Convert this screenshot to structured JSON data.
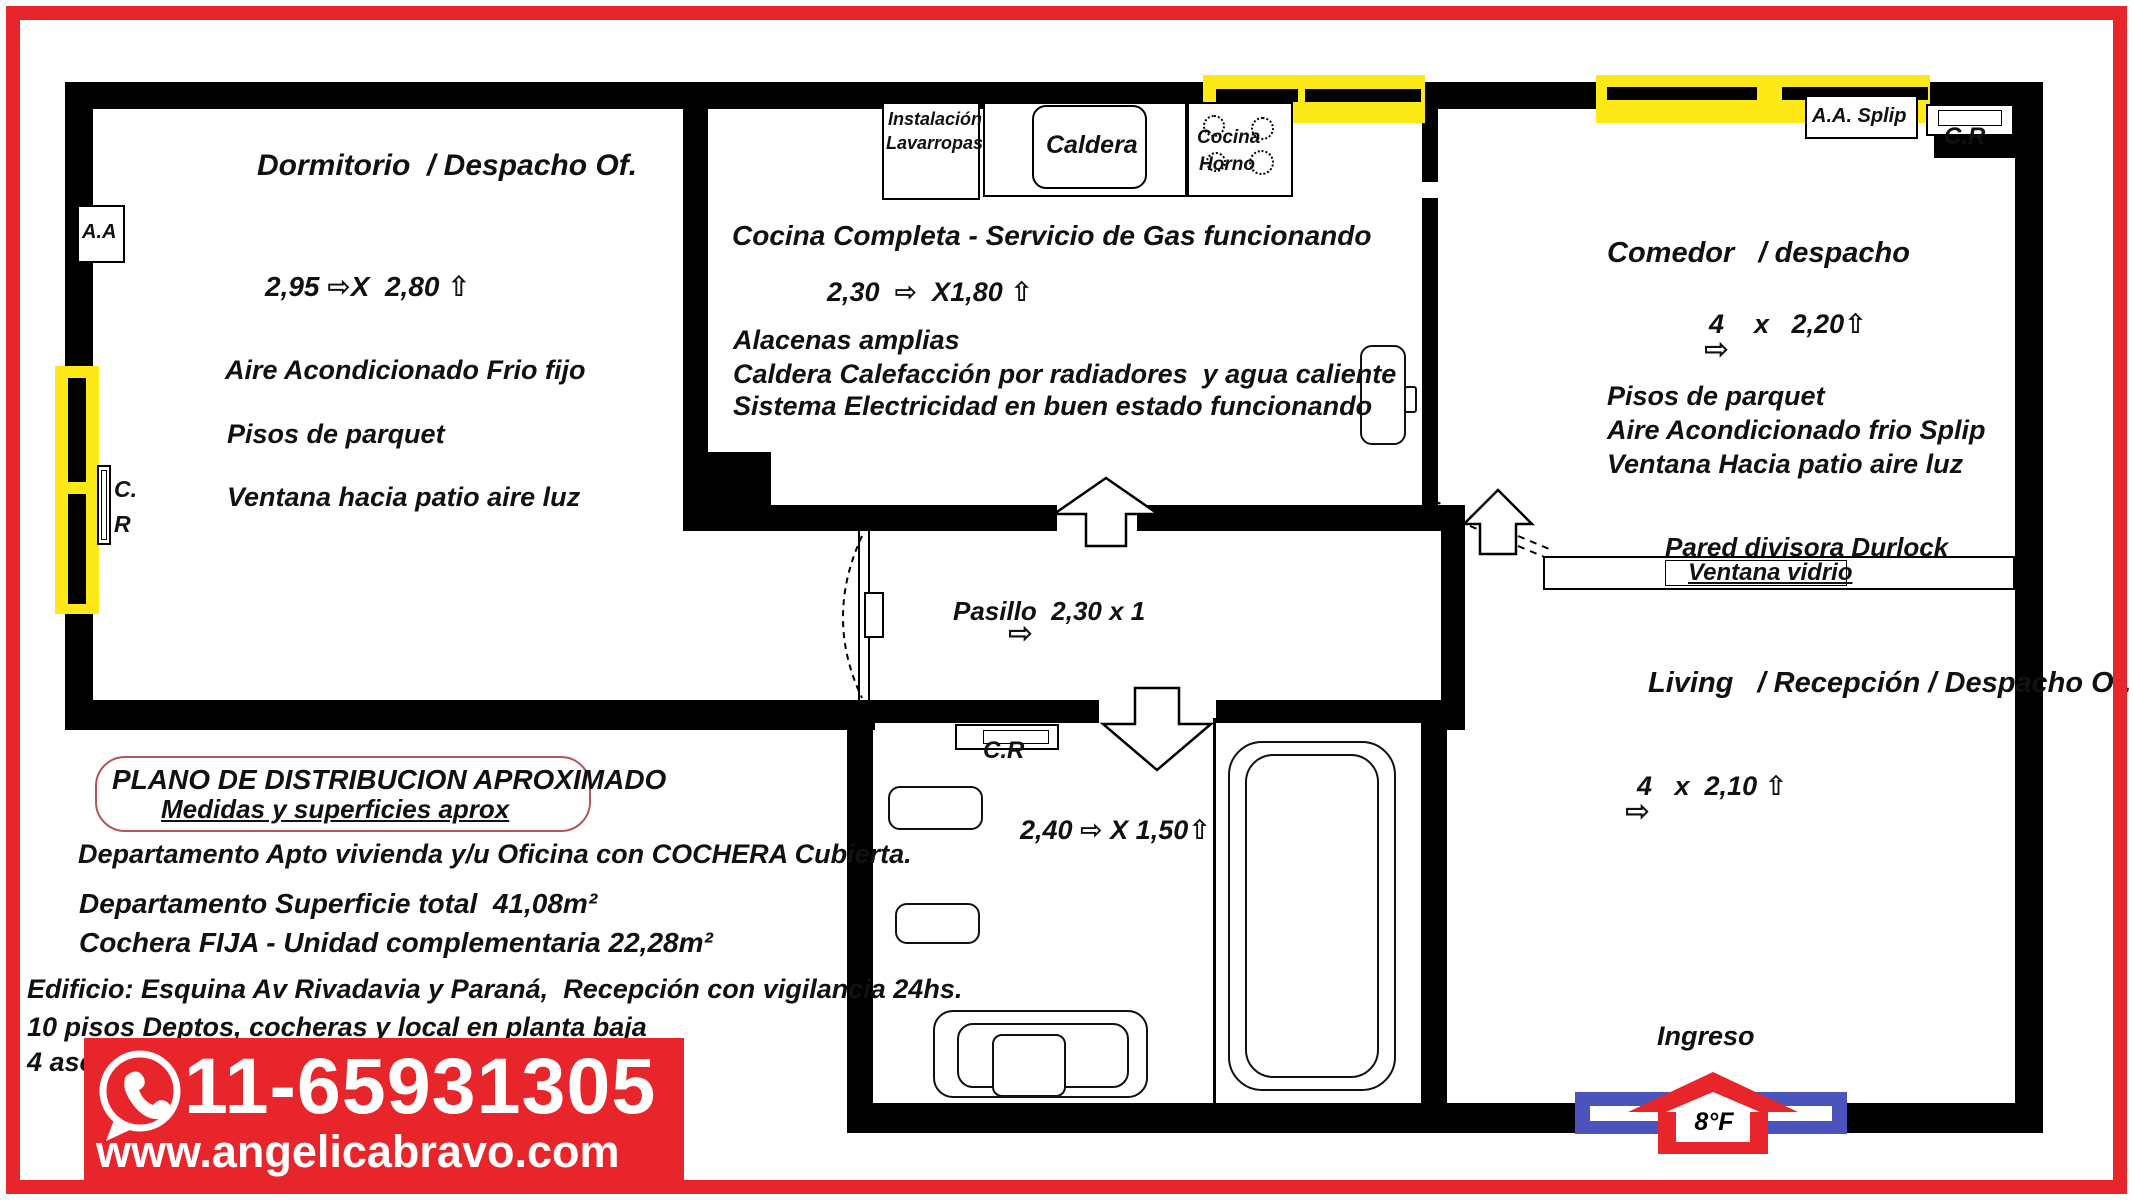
{
  "plan": {
    "dormitorio": {
      "title": "Dormitorio  / Despacho Of.",
      "dims": "2,95 ⇨X  2,80 ⇧",
      "features": [
        "Aire Acondicionado Frio fijo",
        "Pisos de parquet",
        "Ventana hacia patio aire luz"
      ],
      "aa_label": "A.A",
      "cr_line1": "C.",
      "cr_line2": "R"
    },
    "kitchen": {
      "lavarropas_line1": "Instalación",
      "lavarropas_line2": "Lavarropas",
      "caldera_label": "Caldera",
      "stove_line1": "Cocina",
      "stove_line2": "Horno",
      "title": "Cocina Completa - Servicio de Gas funcionando",
      "dims": "2,30  ⇨  X1,80 ⇧",
      "features": [
        "Alacenas amplias",
        "Caldera Calefacción por radiadores  y agua caliente",
        "Sistema Electricidad en buen estado funcionando"
      ]
    },
    "pasillo": {
      "label": "Pasillo  2,30 x 1",
      "arrow": "⇨"
    },
    "comedor": {
      "aa_splip_label": "A.A. Splip",
      "cr_label": "C.R",
      "title": "Comedor   / despacho",
      "dims": "4    x   2,20⇧",
      "dims_arrow": "⇨",
      "features": [
        "Pisos de parquet",
        "Aire Acondicionado frio Splip",
        "Ventana Hacia patio aire luz"
      ],
      "partition_label": "Pared divisora Durlock",
      "partition_window_label": "Ventana vidrio"
    },
    "living": {
      "title": "Living   / Recepción / Despacho Of.",
      "dims": "4   x  2,10 ⇧",
      "dims_arrow": "⇨",
      "ingreso_label": "Ingreso",
      "unit_label": "8°F"
    },
    "bath": {
      "cr_label": "C.R",
      "dims": "2,40 ⇨ X 1,50⇧"
    }
  },
  "infobox": {
    "title": "PLANO DE DISTRIBUCION APROXIMADO",
    "subtitle": "Medidas y superficies aprox",
    "line1": "Departamento Apto vivienda y/u Oficina con COCHERA Cubierta.",
    "line2": "Departamento Superficie total  41,08m²",
    "line3": "Cochera FIJA - Unidad complementaria 22,28m²",
    "line4": "Edificio: Esquina Av Rivadavia y Paraná,  Recepción con vigilancia 24hs.",
    "line5": "10 pisos Deptos, cocheras y local en planta baja",
    "line6": "4 ascensores llegan al 2°S.S."
  },
  "banner": {
    "phone": "11-65931305",
    "url": "www.angelicabravo.com"
  },
  "colors": {
    "accent_red": "#e8252a",
    "window_yellow": "#fde915",
    "door_blue": "#4a54bc",
    "wall_black": "#000000",
    "plano_box_border": "#b2565c"
  }
}
